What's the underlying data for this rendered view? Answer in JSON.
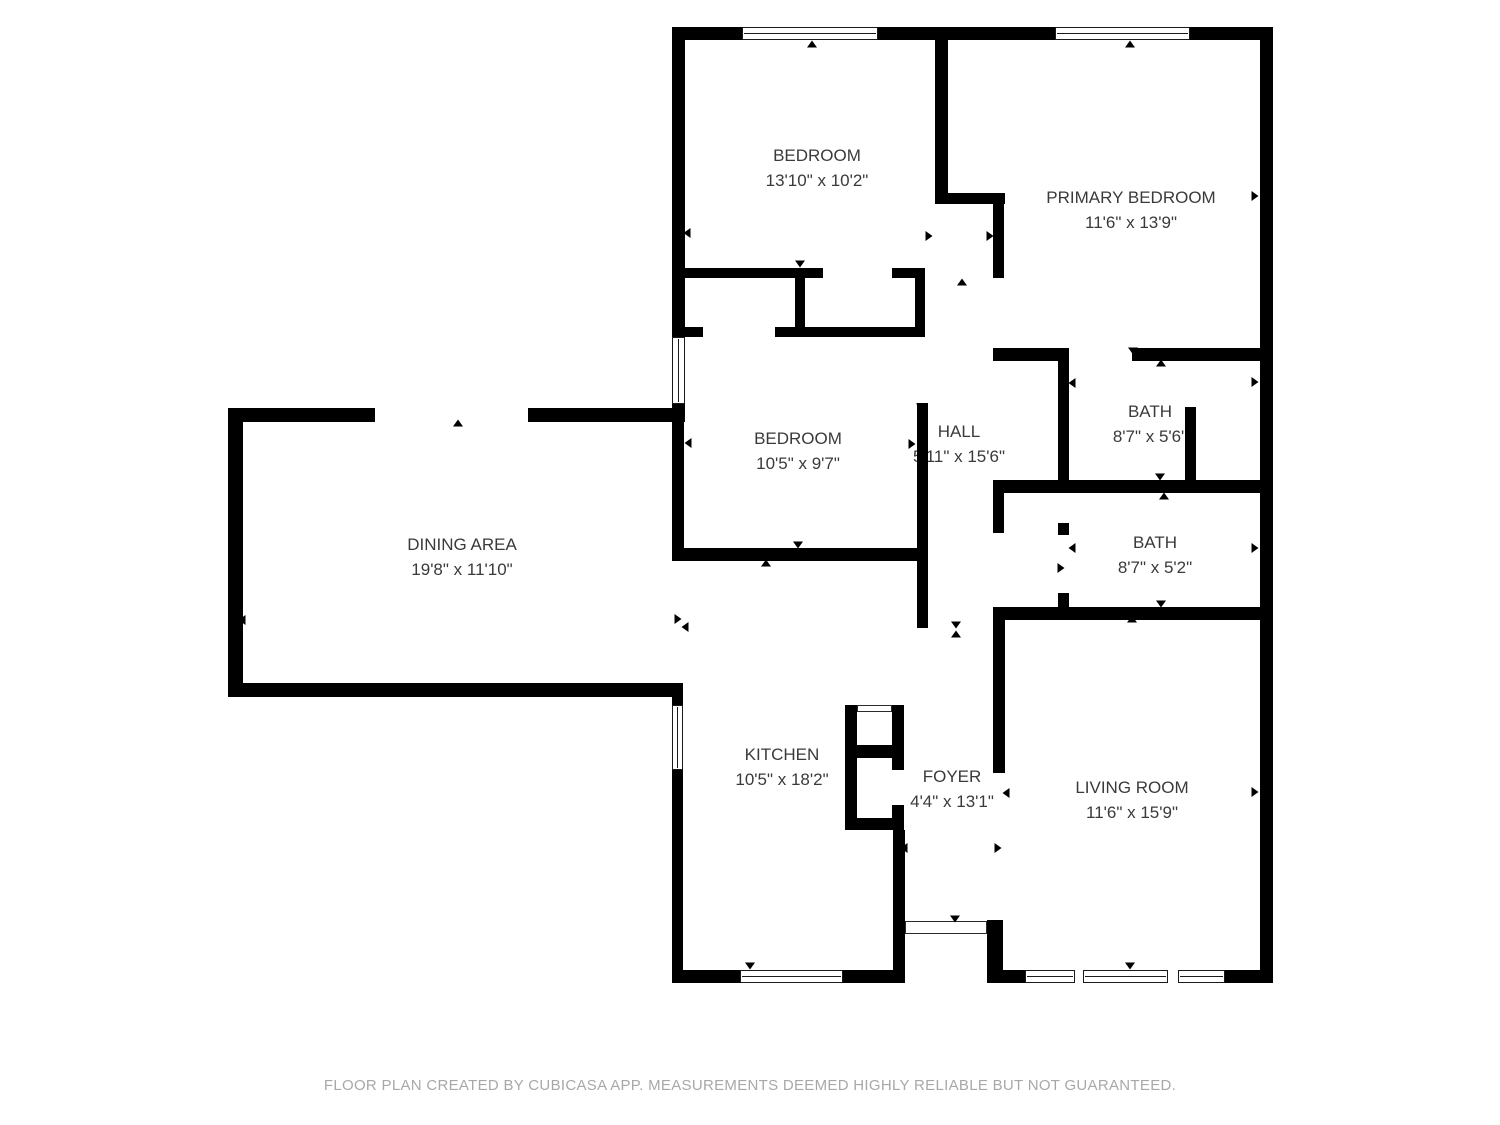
{
  "footer": {
    "disclaimer": "FLOOR PLAN CREATED BY CUBICASA APP. MEASUREMENTS DEEMED HIGHLY RELIABLE BUT NOT GUARANTEED."
  },
  "colors": {
    "wall": "#000000",
    "label_text": "#3a3a3a",
    "footer_text": "#a8a8a8",
    "background": "#ffffff"
  },
  "rooms": [
    {
      "id": "bedroom-top",
      "name": "BEDROOM",
      "dims": "13'10\" x 10'2\""
    },
    {
      "id": "primary-bedroom",
      "name": "PRIMARY BEDROOM",
      "dims": "11'6\" x 13'9\""
    },
    {
      "id": "bedroom-middle",
      "name": "BEDROOM",
      "dims": "10'5\" x 9'7\""
    },
    {
      "id": "hall",
      "name": "HALL",
      "dims": "5'11\" x 15'6\""
    },
    {
      "id": "bath-1",
      "name": "BATH",
      "dims": "8'7\" x 5'6\""
    },
    {
      "id": "bath-2",
      "name": "BATH",
      "dims": "8'7\" x 5'2\""
    },
    {
      "id": "dining-area",
      "name": "DINING AREA",
      "dims": "19'8\" x 11'10\""
    },
    {
      "id": "kitchen",
      "name": "KITCHEN",
      "dims": "10'5\" x 18'2\""
    },
    {
      "id": "foyer",
      "name": "FOYER",
      "dims": "4'4\" x 13'1\""
    },
    {
      "id": "living-room",
      "name": "LIVING ROOM",
      "dims": "11'6\" x 15'9\""
    }
  ],
  "floorplan": {
    "walls": [
      [
        672,
        27,
        70,
        13
      ],
      [
        878,
        27,
        177,
        13
      ],
      [
        1190,
        27,
        83,
        13
      ],
      [
        1260,
        27,
        13,
        956
      ],
      [
        672,
        27,
        13,
        310
      ],
      [
        672,
        404,
        13,
        18
      ],
      [
        672,
        422,
        12,
        139
      ],
      [
        935,
        27,
        13,
        166
      ],
      [
        935,
        193,
        70,
        11
      ],
      [
        993,
        204,
        11,
        74
      ],
      [
        685,
        268,
        138,
        10
      ],
      [
        892,
        268,
        33,
        10
      ],
      [
        795,
        278,
        10,
        50
      ],
      [
        915,
        268,
        10,
        69
      ],
      [
        685,
        327,
        18,
        10
      ],
      [
        775,
        327,
        150,
        10
      ],
      [
        672,
        548,
        256,
        13
      ],
      [
        917,
        403,
        11,
        145
      ],
      [
        917,
        548,
        11,
        80
      ],
      [
        993,
        348,
        75,
        13
      ],
      [
        1132,
        348,
        131,
        13
      ],
      [
        1058,
        348,
        11,
        142
      ],
      [
        993,
        480,
        270,
        13
      ],
      [
        1185,
        407,
        11,
        76
      ],
      [
        993,
        490,
        11,
        43
      ],
      [
        1058,
        523,
        11,
        12
      ],
      [
        1058,
        593,
        11,
        15
      ],
      [
        993,
        607,
        270,
        13
      ],
      [
        993,
        620,
        12,
        153
      ],
      [
        987,
        920,
        16,
        63
      ],
      [
        1003,
        970,
        22,
        13
      ],
      [
        1225,
        970,
        48,
        13
      ],
      [
        228,
        408,
        147,
        14
      ],
      [
        528,
        408,
        147,
        14
      ],
      [
        228,
        408,
        15,
        289
      ],
      [
        228,
        683,
        455,
        14
      ],
      [
        672,
        683,
        11,
        22
      ],
      [
        672,
        770,
        11,
        213
      ],
      [
        672,
        970,
        68,
        13
      ],
      [
        843,
        970,
        62,
        13
      ],
      [
        893,
        830,
        12,
        153
      ],
      [
        845,
        705,
        12,
        125
      ],
      [
        892,
        705,
        12,
        65
      ],
      [
        845,
        745,
        58,
        13
      ],
      [
        892,
        805,
        12,
        25
      ],
      [
        845,
        818,
        58,
        12
      ]
    ],
    "windows": [
      {
        "x": 742,
        "y": 27,
        "w": 136,
        "h": 13,
        "orient": "h"
      },
      {
        "x": 1055,
        "y": 27,
        "w": 135,
        "h": 13,
        "orient": "h"
      },
      {
        "x": 672,
        "y": 337,
        "w": 13,
        "h": 67,
        "orient": "v"
      },
      {
        "x": 672,
        "y": 705,
        "w": 11,
        "h": 65,
        "orient": "v"
      },
      {
        "x": 740,
        "y": 970,
        "w": 103,
        "h": 13,
        "orient": "h"
      },
      {
        "x": 1025,
        "y": 970,
        "w": 50,
        "h": 13,
        "orient": "h"
      },
      {
        "x": 1083,
        "y": 970,
        "w": 85,
        "h": 13,
        "orient": "h"
      },
      {
        "x": 1178,
        "y": 970,
        "w": 47,
        "h": 13,
        "orient": "h"
      }
    ],
    "thin_frames": [
      {
        "x": 857,
        "y": 705,
        "w": 35,
        "h": 7
      },
      {
        "x": 905,
        "y": 921,
        "w": 82,
        "h": 13
      }
    ],
    "markers": [
      [
        812,
        44,
        "u"
      ],
      [
        687,
        233,
        "l"
      ],
      [
        929,
        236,
        "r"
      ],
      [
        800,
        264,
        "d"
      ],
      [
        1130,
        44,
        "u"
      ],
      [
        990,
        236,
        "r"
      ],
      [
        1255,
        196,
        "r"
      ],
      [
        1133,
        351,
        "d"
      ],
      [
        962,
        282,
        "u"
      ],
      [
        924,
        446,
        "l"
      ],
      [
        956,
        625,
        "d"
      ],
      [
        800,
        333,
        "u"
      ],
      [
        688,
        443,
        "l"
      ],
      [
        912,
        444,
        "r"
      ],
      [
        798,
        545,
        "d"
      ],
      [
        921,
        407,
        "d"
      ],
      [
        458,
        423,
        "u"
      ],
      [
        242,
        620,
        "l"
      ],
      [
        678,
        619,
        "r"
      ],
      [
        458,
        687,
        "d"
      ],
      [
        685,
        627,
        "l"
      ],
      [
        766,
        563,
        "u"
      ],
      [
        750,
        966,
        "d"
      ],
      [
        1161,
        363,
        "u"
      ],
      [
        1072,
        383,
        "l"
      ],
      [
        1255,
        382,
        "r"
      ],
      [
        1160,
        477,
        "d"
      ],
      [
        1164,
        496,
        "u"
      ],
      [
        1072,
        548,
        "l"
      ],
      [
        1255,
        548,
        "r"
      ],
      [
        1161,
        604,
        "d"
      ],
      [
        1061,
        568,
        "r"
      ],
      [
        956,
        634,
        "u"
      ],
      [
        955,
        919,
        "d"
      ],
      [
        904,
        848,
        "l"
      ],
      [
        998,
        848,
        "r"
      ],
      [
        1132,
        619,
        "u"
      ],
      [
        1006,
        793,
        "l"
      ],
      [
        1255,
        792,
        "r"
      ],
      [
        1130,
        966,
        "d"
      ]
    ]
  }
}
